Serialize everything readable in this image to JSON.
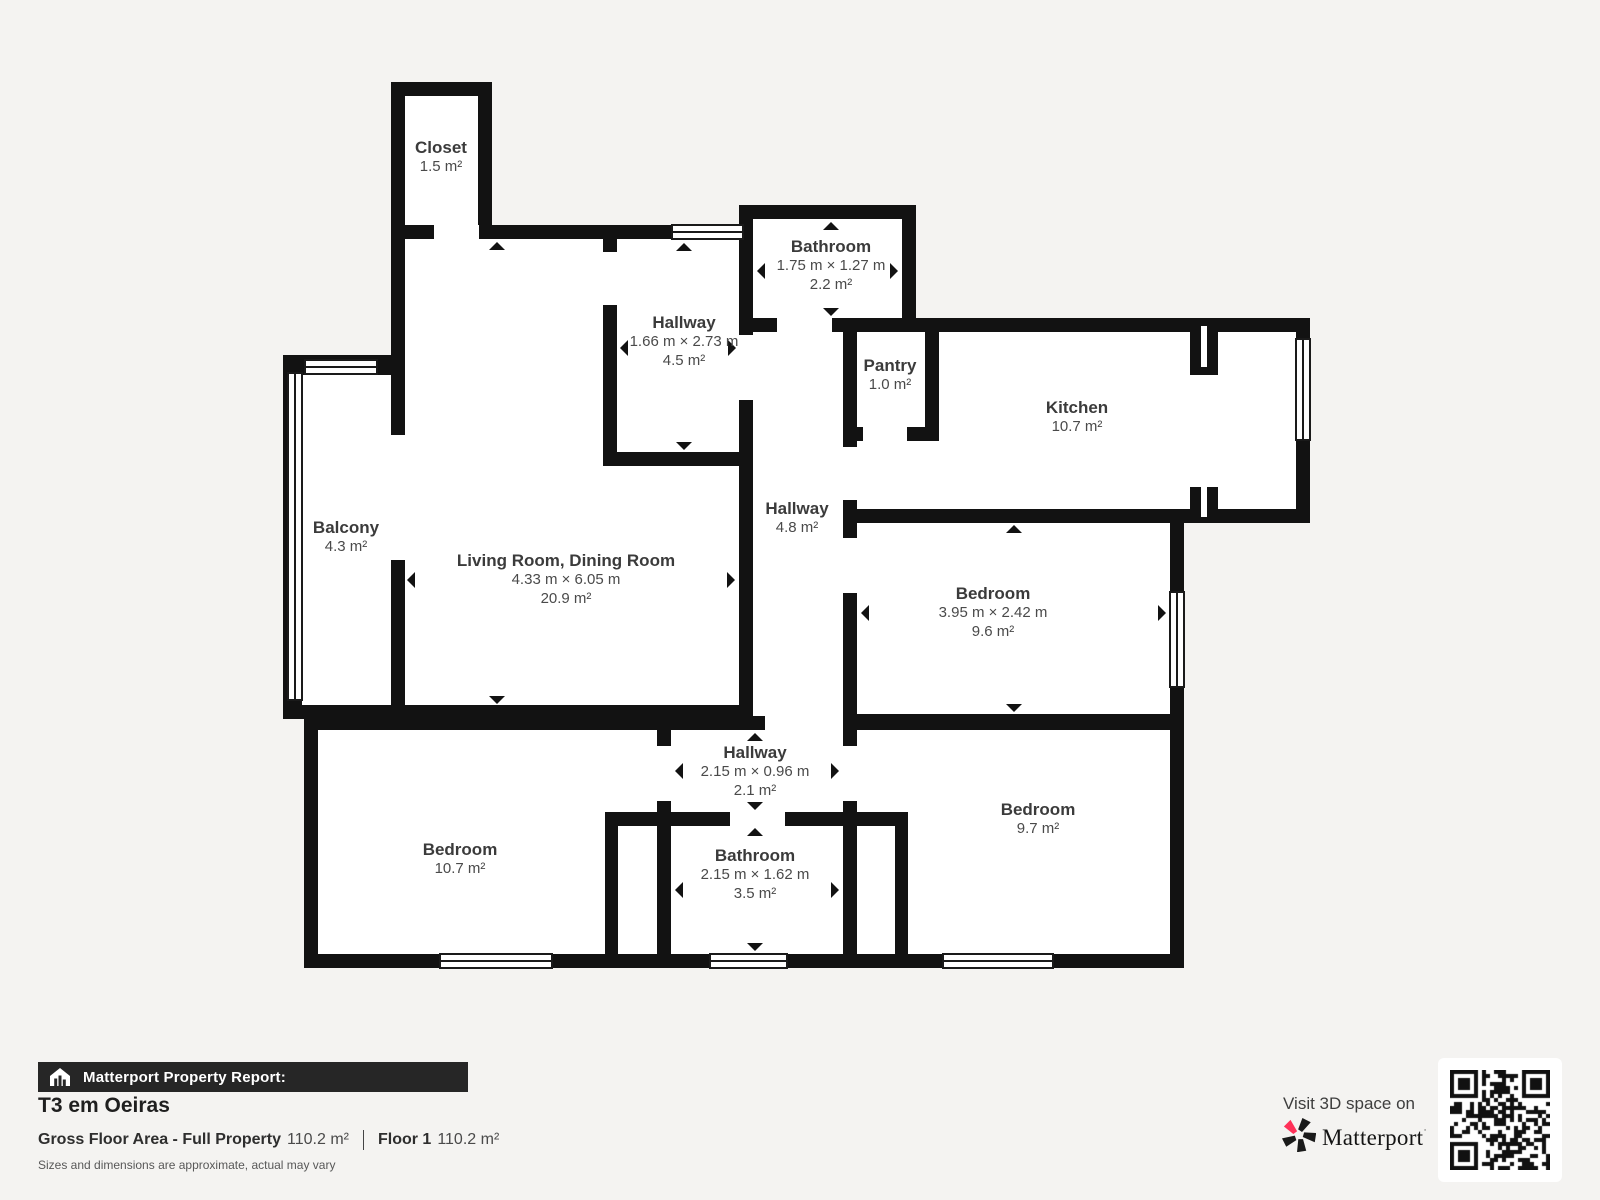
{
  "colors": {
    "wall": "#121212",
    "page_bg": "#f4f3f1",
    "floor": "#ffffff",
    "bar_bg": "#262626",
    "brand_pink": "#ff3158",
    "label_text": "#3b3b3b"
  },
  "rooms": {
    "closet": {
      "name": "Closet",
      "area": "1.5 m²"
    },
    "bathroom_top": {
      "name": "Bathroom",
      "dims": "1.75 m × 1.27 m",
      "area": "2.2 m²"
    },
    "hallway_top": {
      "name": "Hallway",
      "dims": "1.66 m × 2.73 m",
      "area": "4.5 m²"
    },
    "pantry": {
      "name": "Pantry",
      "area": "1.0 m²"
    },
    "kitchen": {
      "name": "Kitchen",
      "area": "10.7 m²"
    },
    "hallway_mid": {
      "name": "Hallway",
      "area": "4.8 m²"
    },
    "balcony": {
      "name": "Balcony",
      "area": "4.3 m²"
    },
    "living": {
      "name": "Living Room, Dining Room",
      "dims": "4.33 m × 6.05 m",
      "area": "20.9 m²"
    },
    "bedroom_right": {
      "name": "Bedroom",
      "dims": "3.95 m × 2.42 m",
      "area": "9.6 m²"
    },
    "hallway_bottom": {
      "name": "Hallway",
      "dims": "2.15 m × 0.96 m",
      "area": "2.1 m²"
    },
    "bathroom_bottom": {
      "name": "Bathroom",
      "dims": "2.15 m × 1.62 m",
      "area": "3.5 m²"
    },
    "bedroom_left": {
      "name": "Bedroom",
      "area": "10.7 m²"
    },
    "bedroom_bottom_right": {
      "name": "Bedroom",
      "area": "9.7 m²"
    }
  },
  "report": {
    "bar_label": "Matterport Property Report:",
    "title": "T3 em Oeiras",
    "gross_label": "Gross Floor Area - Full Property",
    "gross_value": "110.2 m²",
    "floor_label": "Floor 1",
    "floor_value": "110.2 m²",
    "disclaimer": "Sizes and dimensions are approximate, actual may vary"
  },
  "promo": {
    "visit_text": "Visit 3D space on",
    "brand": "Matterport",
    "brand_mark": "˙"
  }
}
